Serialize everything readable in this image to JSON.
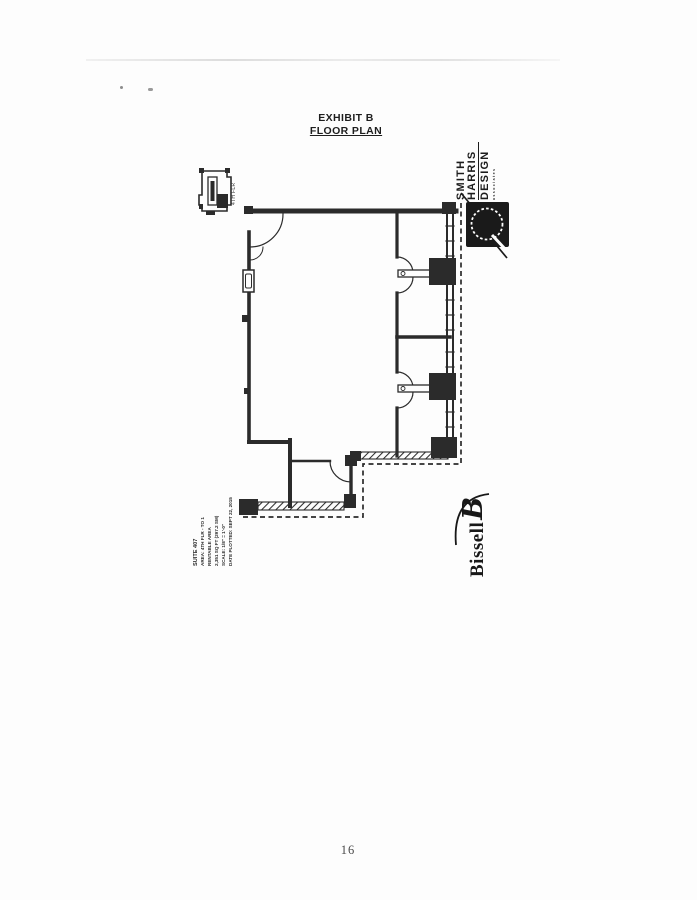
{
  "document": {
    "title_line1": "EXHIBIT B",
    "title_line2": "FLOOR PLAN",
    "page_number": "16"
  },
  "floor_plan": {
    "key_plan_label": "4TH FLR",
    "title_block_lines": [
      "SUITE 407",
      "AREA: 4TH FLR - TO 1",
      "RENTABLE AREA",
      "2,351 SQ FT (297.2 SM)",
      "SCALE: 1/8\" = 1'-0\"",
      "DATE PLOTTED: SEPT 22, 2015"
    ]
  },
  "logos": {
    "smith_harris": {
      "line1": "SMITH",
      "line2": "HARRIS",
      "line3": "DESIGN",
      "tagline": "associates"
    },
    "bissell": {
      "wordmark": "Bissell",
      "monogram": "B"
    }
  },
  "colors": {
    "ink": "#2b2b2b",
    "paper": "#fdfdfd",
    "page_number_gray": "#4a4a4a"
  }
}
